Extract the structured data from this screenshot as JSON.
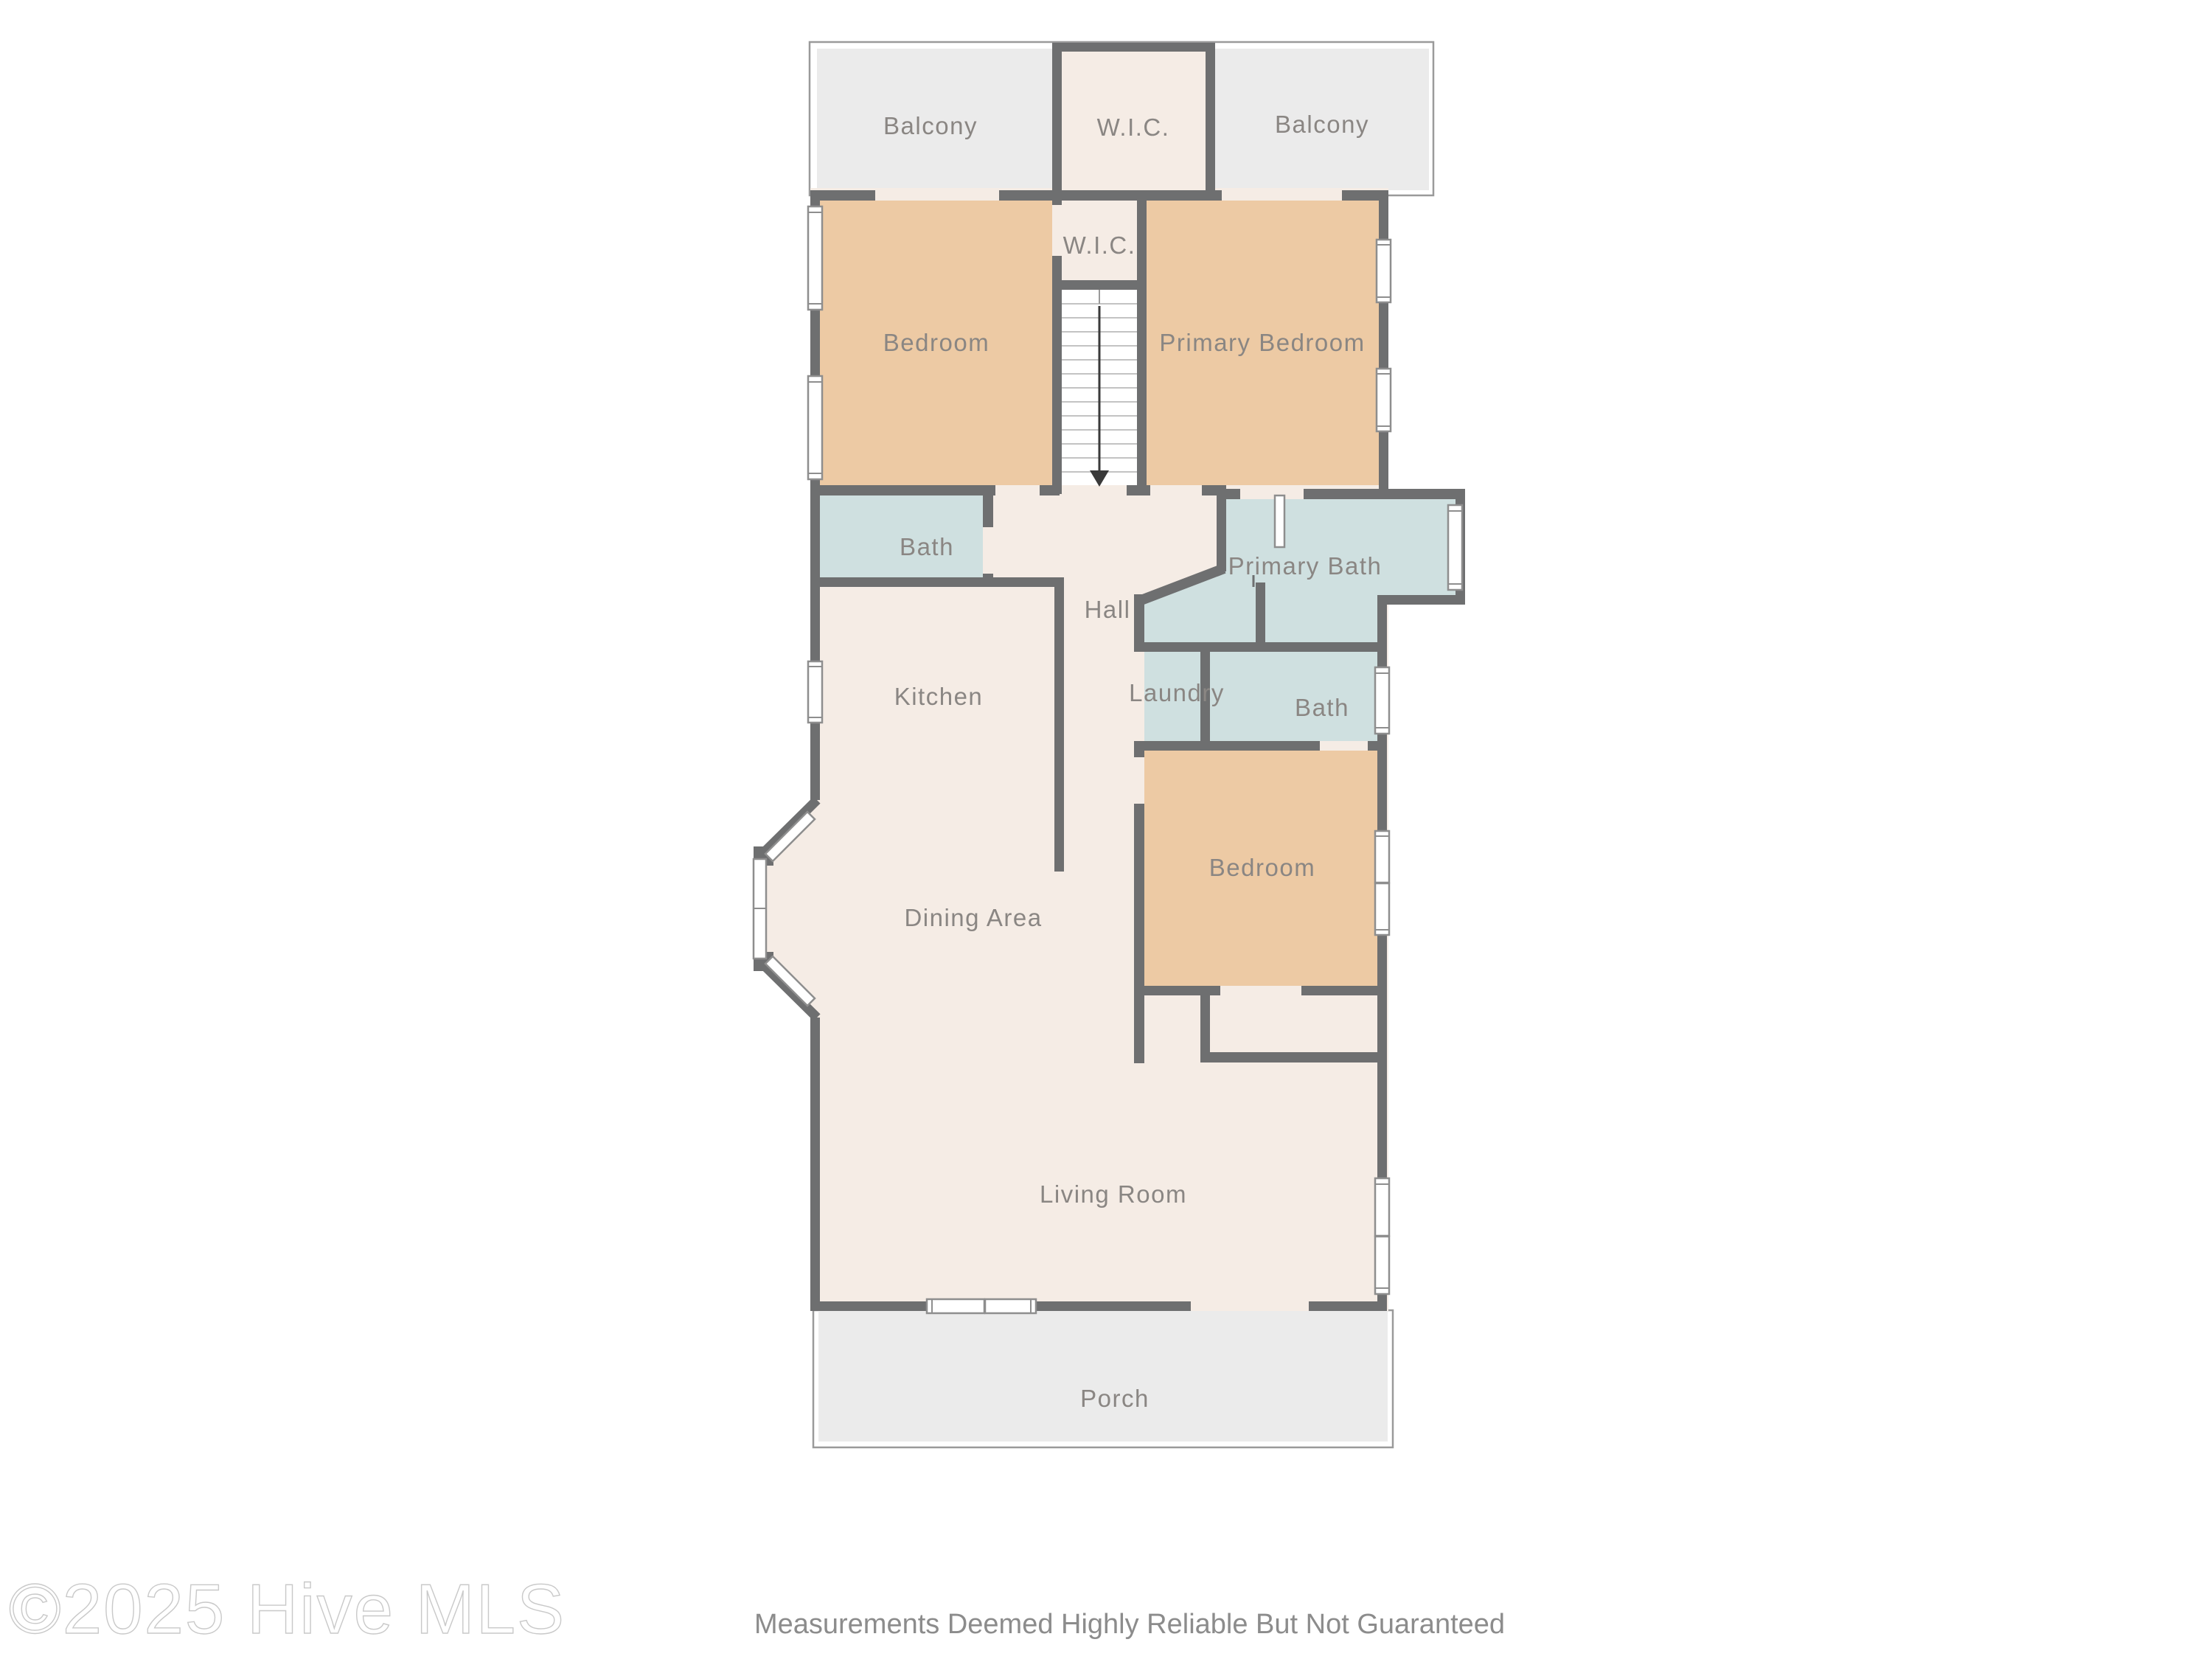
{
  "footer": {
    "watermark": "©2025 Hive MLS",
    "disclaimer": "Measurements Deemed Highly Reliable But Not Guaranteed"
  },
  "rooms": [
    {
      "id": "balcony-left",
      "label": "Balcony"
    },
    {
      "id": "wic-top",
      "label": "W.I.C."
    },
    {
      "id": "balcony-right",
      "label": "Balcony"
    },
    {
      "id": "wic-stair",
      "label": "W.I.C."
    },
    {
      "id": "bedroom-1",
      "label": "Bedroom"
    },
    {
      "id": "primary-bedroom",
      "label": "Primary Bedroom"
    },
    {
      "id": "bath-1",
      "label": "Bath"
    },
    {
      "id": "hall",
      "label": "Hall"
    },
    {
      "id": "primary-bath",
      "label": "Primary Bath"
    },
    {
      "id": "kitchen",
      "label": "Kitchen"
    },
    {
      "id": "laundry",
      "label": "Laundry"
    },
    {
      "id": "bath-2",
      "label": "Bath"
    },
    {
      "id": "dining-area",
      "label": "Dining Area"
    },
    {
      "id": "bedroom-2",
      "label": "Bedroom"
    },
    {
      "id": "living-room",
      "label": "Living Room"
    },
    {
      "id": "porch",
      "label": "Porch"
    }
  ],
  "features": {
    "stair_direction": "down"
  },
  "palette": {
    "wall": "#6e6f70",
    "bedroom": "#edcaa4",
    "bath": "#cfe0e0",
    "floor": "#f5ece5",
    "outdoor": "#ebebeb",
    "label": "#8a8683",
    "arrow": "#3a3a3a"
  }
}
